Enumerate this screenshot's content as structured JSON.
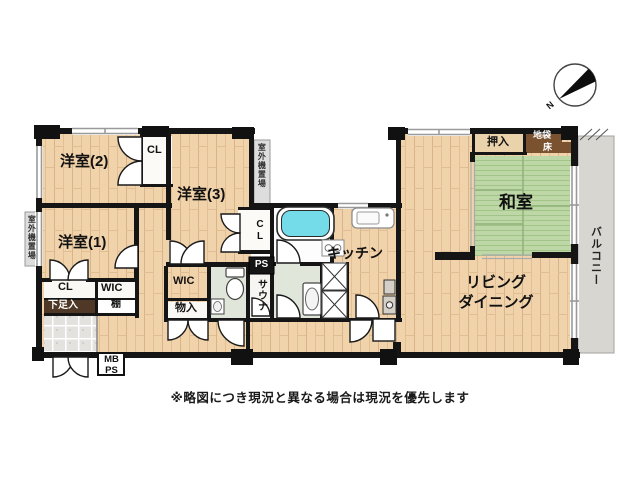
{
  "rooms": {
    "yoshitsu2": "洋室(2)",
    "yoshitsu3": "洋室(3)",
    "yoshitsu1": "洋室(1)",
    "washitsu": "和室",
    "living_line1": "リビング",
    "living_line2": "ダイニング",
    "kitchen": "キッチン"
  },
  "storage": {
    "cl_top": "CL",
    "cl_mid": "CL",
    "cl_entry": "CL",
    "wic_left": "WIC",
    "wic_right": "WIC",
    "monoiri": "物入",
    "oshiire": "押入",
    "jibukuro": "地袋",
    "toko": "床",
    "getabako": "下足入",
    "tana": "棚"
  },
  "utility": {
    "ps": "PS",
    "mb_line1": "MB",
    "mb_line2": "PS",
    "sauna": "サウナ",
    "outdoor_unit_top": "室外機置場",
    "outdoor_unit_left": "室外機置場",
    "balcony": "バルコニー"
  },
  "compass": {
    "n": "N"
  },
  "caption": "※略図につき現況と異なる場合は現況を優先します",
  "colors": {
    "wood": "#f1d3ab",
    "wood_line": "#d9b488",
    "tatami": "#bdd7a6",
    "tatami_line": "#a3c489",
    "dark_wood": "#7a5230",
    "tub_water": "#74dbe8",
    "wet_floor": "#e0e6da",
    "tile": "#e4e2df",
    "balcony": "#d8d6d1",
    "wall": "#151515"
  }
}
